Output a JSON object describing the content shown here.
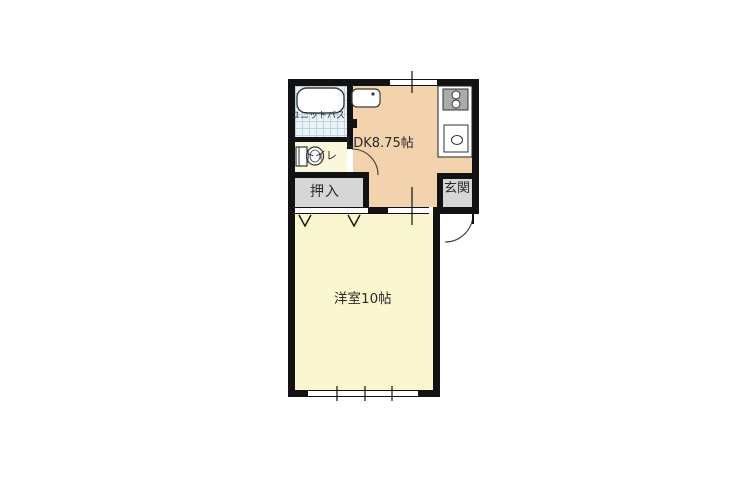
{
  "floorplan": {
    "type": "japanese-apartment-1LDK",
    "rooms": {
      "unit_bath": {
        "label": "ユニットバス"
      },
      "toilet": {
        "label": "トイレ"
      },
      "ldk": {
        "label": "LDK8.75帖"
      },
      "closet": {
        "label": "押入"
      },
      "entrance": {
        "label": "玄関"
      },
      "western_room": {
        "label": "洋室10帖"
      }
    },
    "fixtures": [
      "bathtub-icon",
      "toilet-bowl-icon",
      "washbasin-sink-icon",
      "gas-stove-two-burner-icon",
      "kitchen-sink-icon",
      "toilet-door-swing-arc",
      "entrance-door-swing-arc",
      "sliding-door-symbol",
      "closet-fusuma-chevrons",
      "window-symbol-top",
      "window-symbol-bottom"
    ],
    "colors": {
      "wall": "#121212",
      "ldk_floor": "#f3d3ae",
      "western_room_floor": "#faf6d0",
      "toilet_floor": "#fbf7dc",
      "closet_floor": "#d6d6d6",
      "entrance_floor": "#d6d6d6",
      "bath_tile": "#ecf3f6",
      "bath_tile_grid": "#b9d2e4",
      "counter": "#ffffff",
      "stove": "#ababab",
      "background": "#ffffff",
      "text": "#2a2a2a"
    }
  }
}
